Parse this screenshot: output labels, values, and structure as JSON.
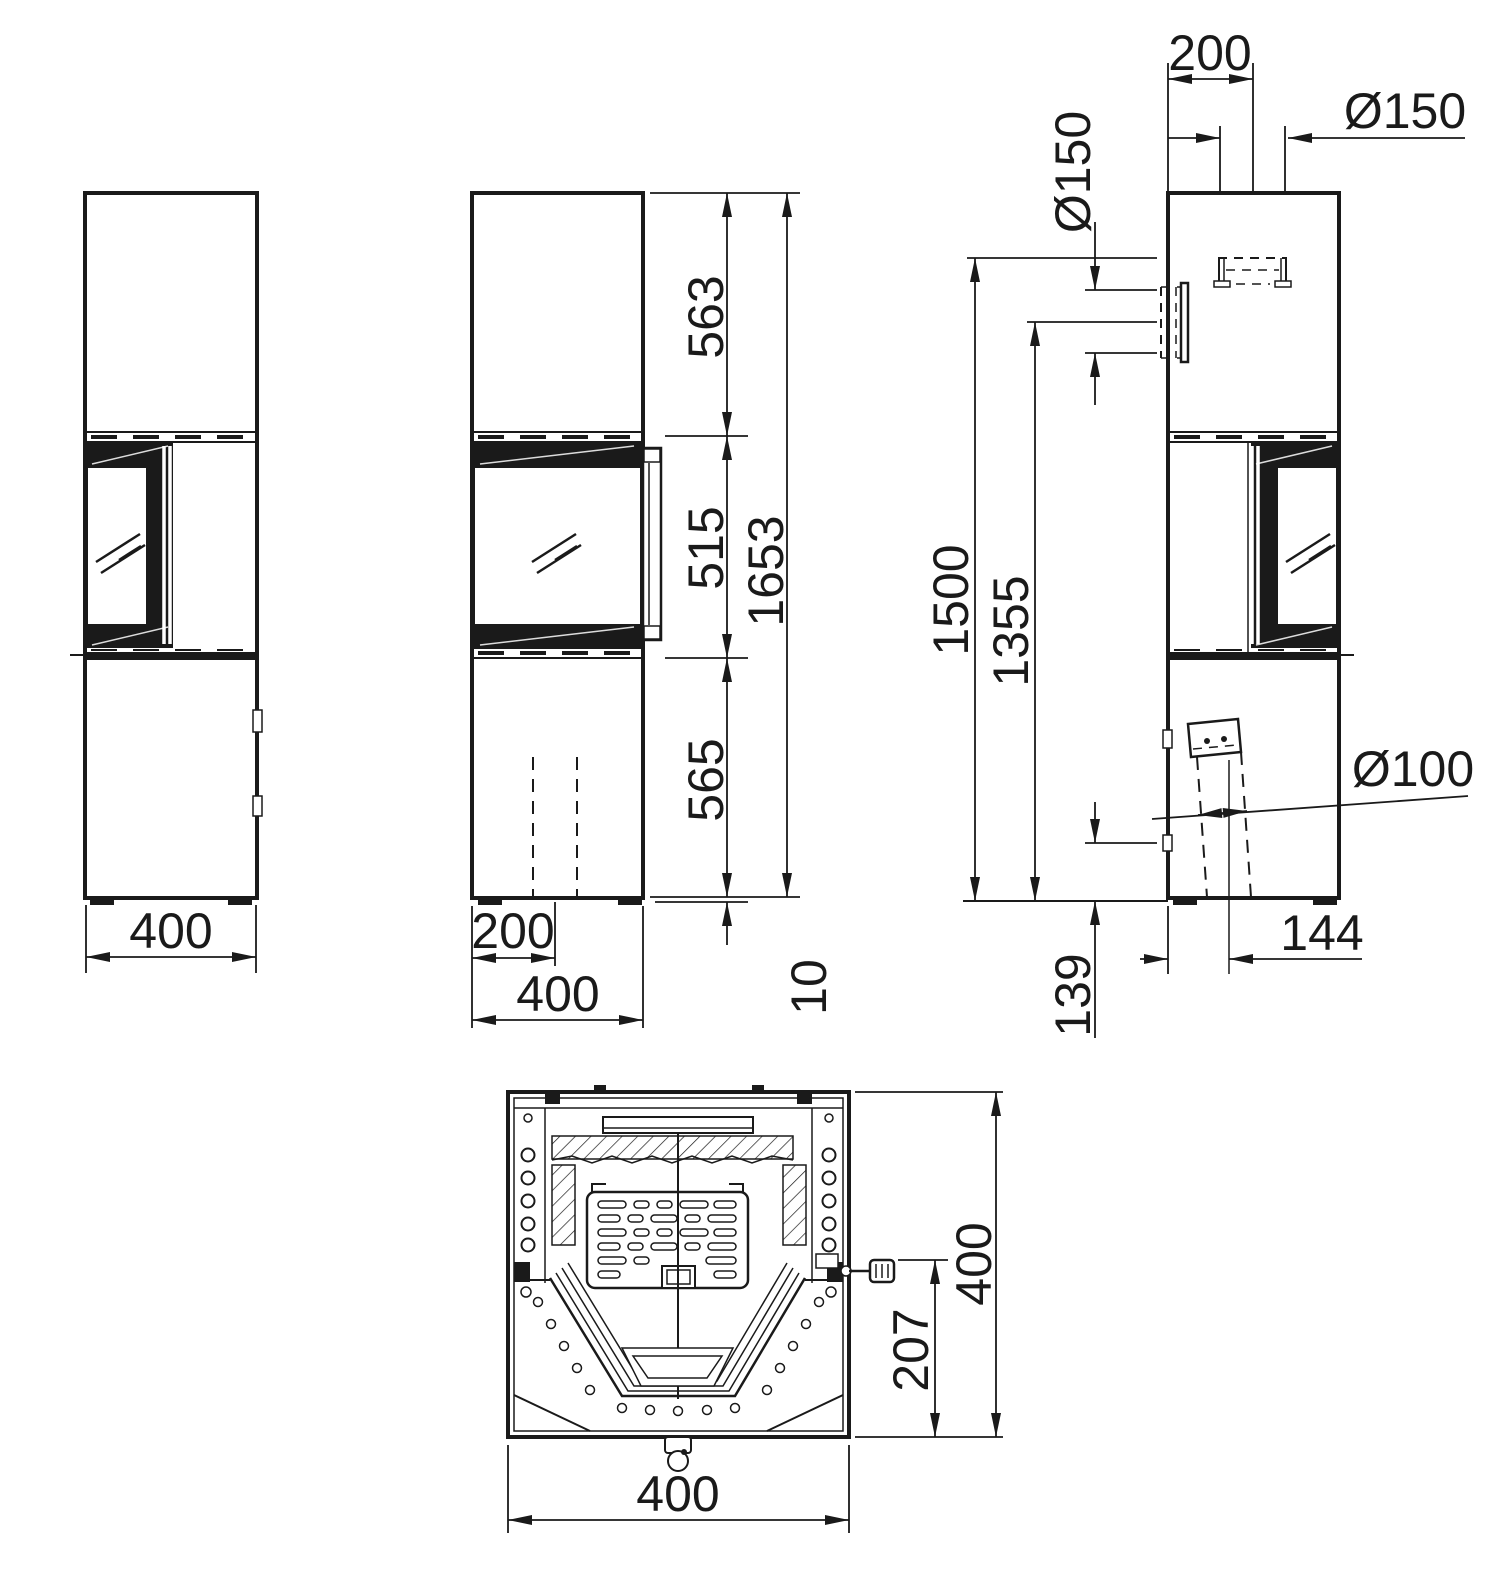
{
  "meta": {
    "ink": "#1a1a1a",
    "background": "#ffffff"
  },
  "views": {
    "left": {
      "width": "400"
    },
    "front": {
      "seg_top": "563",
      "seg_window": "515",
      "seg_base": "565",
      "total_height": "1653",
      "foot_height": "10",
      "flue_offset": "200",
      "width": "400"
    },
    "right": {
      "top_flue_offset": "200",
      "top_flue_dia": "Ø150",
      "rear_flue_dia": "Ø150",
      "top_flue_height": "1500",
      "rear_flue_height": "1355",
      "intake_dia": "Ø100",
      "intake_offset": "144",
      "intake_height": "139"
    },
    "bottom": {
      "width": "400",
      "depth": "400",
      "handle_depth": "207"
    }
  }
}
